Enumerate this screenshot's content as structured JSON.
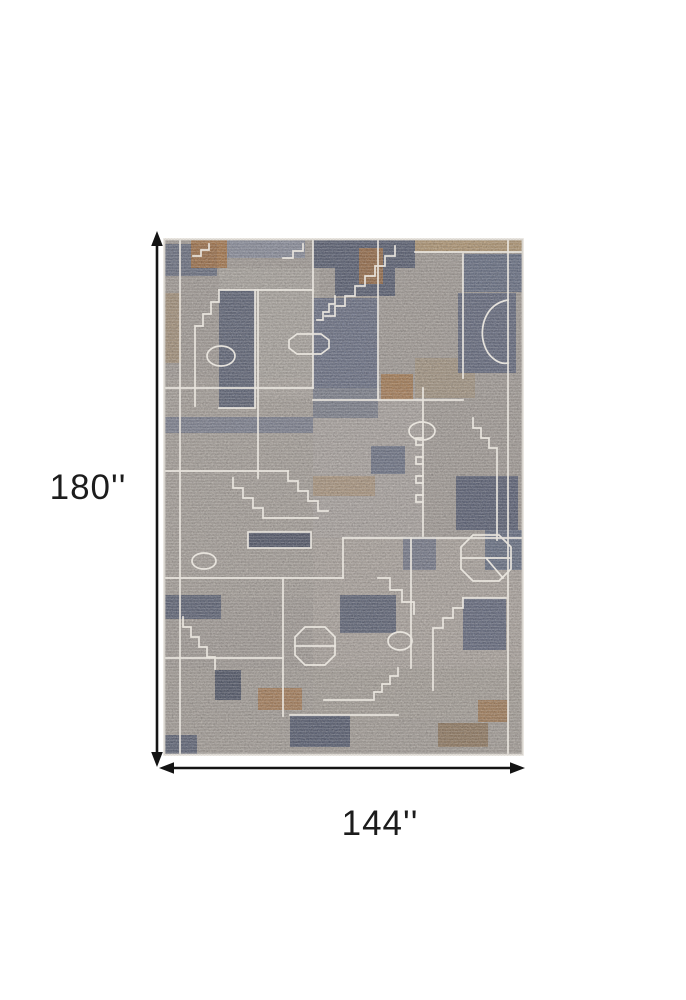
{
  "diagram": {
    "type": "product-dimension-diagram",
    "subject": "abstract geometric patchwork area rug",
    "dimensions": {
      "height": {
        "label": "180''"
      },
      "width": {
        "label": "144''"
      }
    },
    "arrow_color": "#141414",
    "background": "#ffffff"
  },
  "rug": {
    "palette": {
      "base_gray": "#a6a09b",
      "light_gray": "#b3ada8",
      "slate_blue": "#646b80",
      "dark_slate": "#4f5569",
      "steel_blue": "#7a8094",
      "rust": "#a9713d",
      "tan": "#b59a76",
      "outline_cream": "#ebe7e0",
      "edge": "#d8d4ce"
    }
  }
}
